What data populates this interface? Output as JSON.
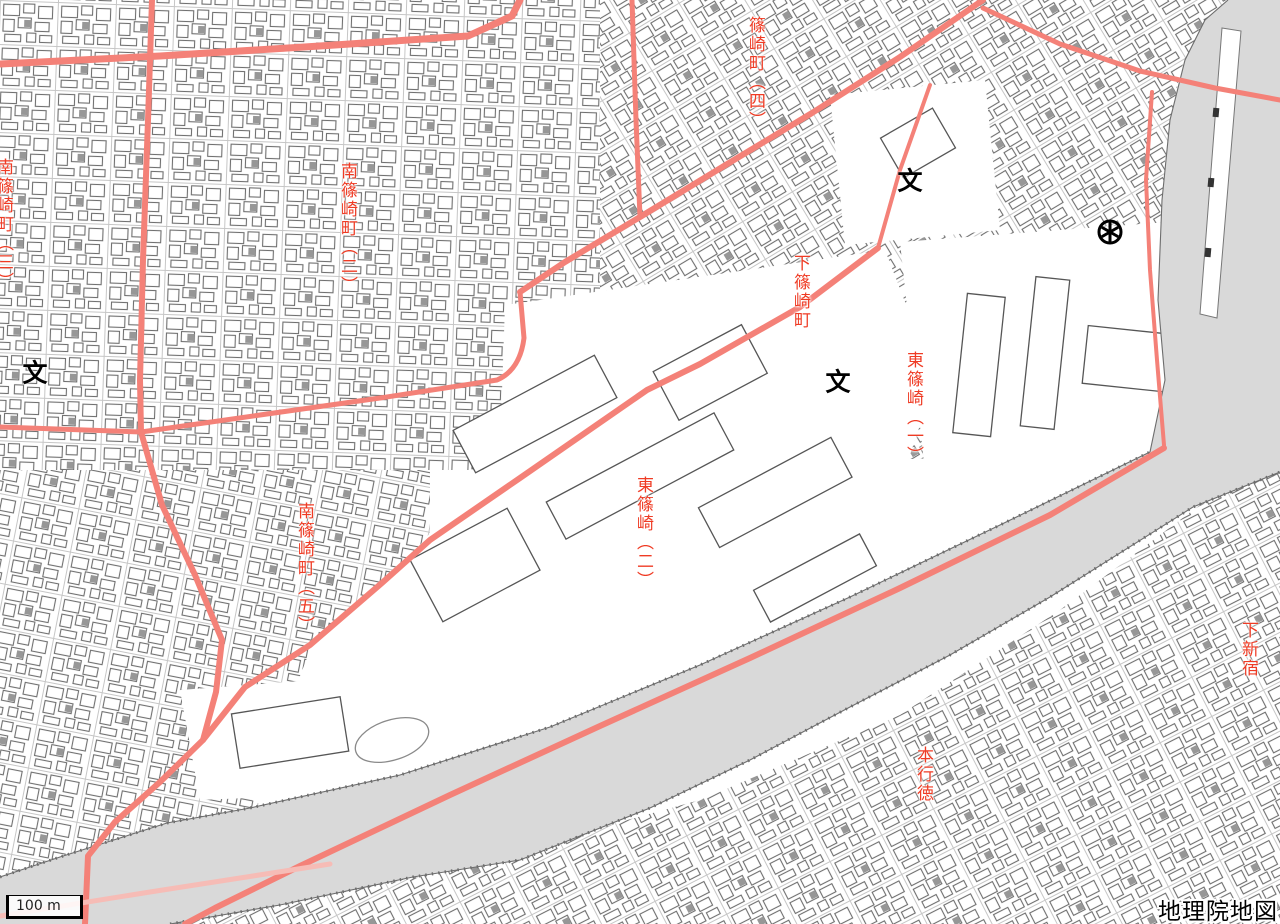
{
  "map": {
    "attribution": "地理院地図",
    "scale_bar": {
      "label": "100 m"
    },
    "labels": [
      {
        "id": "shinozaki-cho-4",
        "text": "篠崎町（四）",
        "x": 746,
        "y": 16
      },
      {
        "id": "minami-shinozaki-cho-3",
        "text": "南篠崎町（三）",
        "x": -6,
        "y": 158
      },
      {
        "id": "minami-shinozaki-cho-2",
        "text": "南篠崎町（二）",
        "x": 338,
        "y": 162
      },
      {
        "id": "shimo-shinozaki-cho",
        "text": "下篠崎町",
        "x": 791,
        "y": 254
      },
      {
        "id": "higashi-shinozaki-1",
        "text": "東篠崎（一）",
        "x": 904,
        "y": 351
      },
      {
        "id": "higashi-shinozaki-2",
        "text": "東篠崎（二）",
        "x": 634,
        "y": 476
      },
      {
        "id": "minami-shinozaki-cho-5",
        "text": "南篠崎町（五）",
        "x": 295,
        "y": 502
      },
      {
        "id": "shimo-shinjuku",
        "text": "下新宿",
        "x": 1239,
        "y": 621
      },
      {
        "id": "hongyotoku",
        "text": "本行徳",
        "x": 914,
        "y": 746
      }
    ],
    "symbols": [
      {
        "type": "school",
        "glyph": "文",
        "x": 910,
        "y": 181
      },
      {
        "type": "school",
        "glyph": "文",
        "x": 35,
        "y": 373
      },
      {
        "type": "school",
        "glyph": "文",
        "x": 838,
        "y": 382
      },
      {
        "type": "health-center",
        "glyph": "",
        "x": 1110,
        "y": 232
      }
    ],
    "colors": {
      "road": "#f48178",
      "road_light": "#f6bcb6",
      "water": "#d9d9d9",
      "label_red": "#ef3b24",
      "building_stroke": "#6f6f6f"
    }
  }
}
